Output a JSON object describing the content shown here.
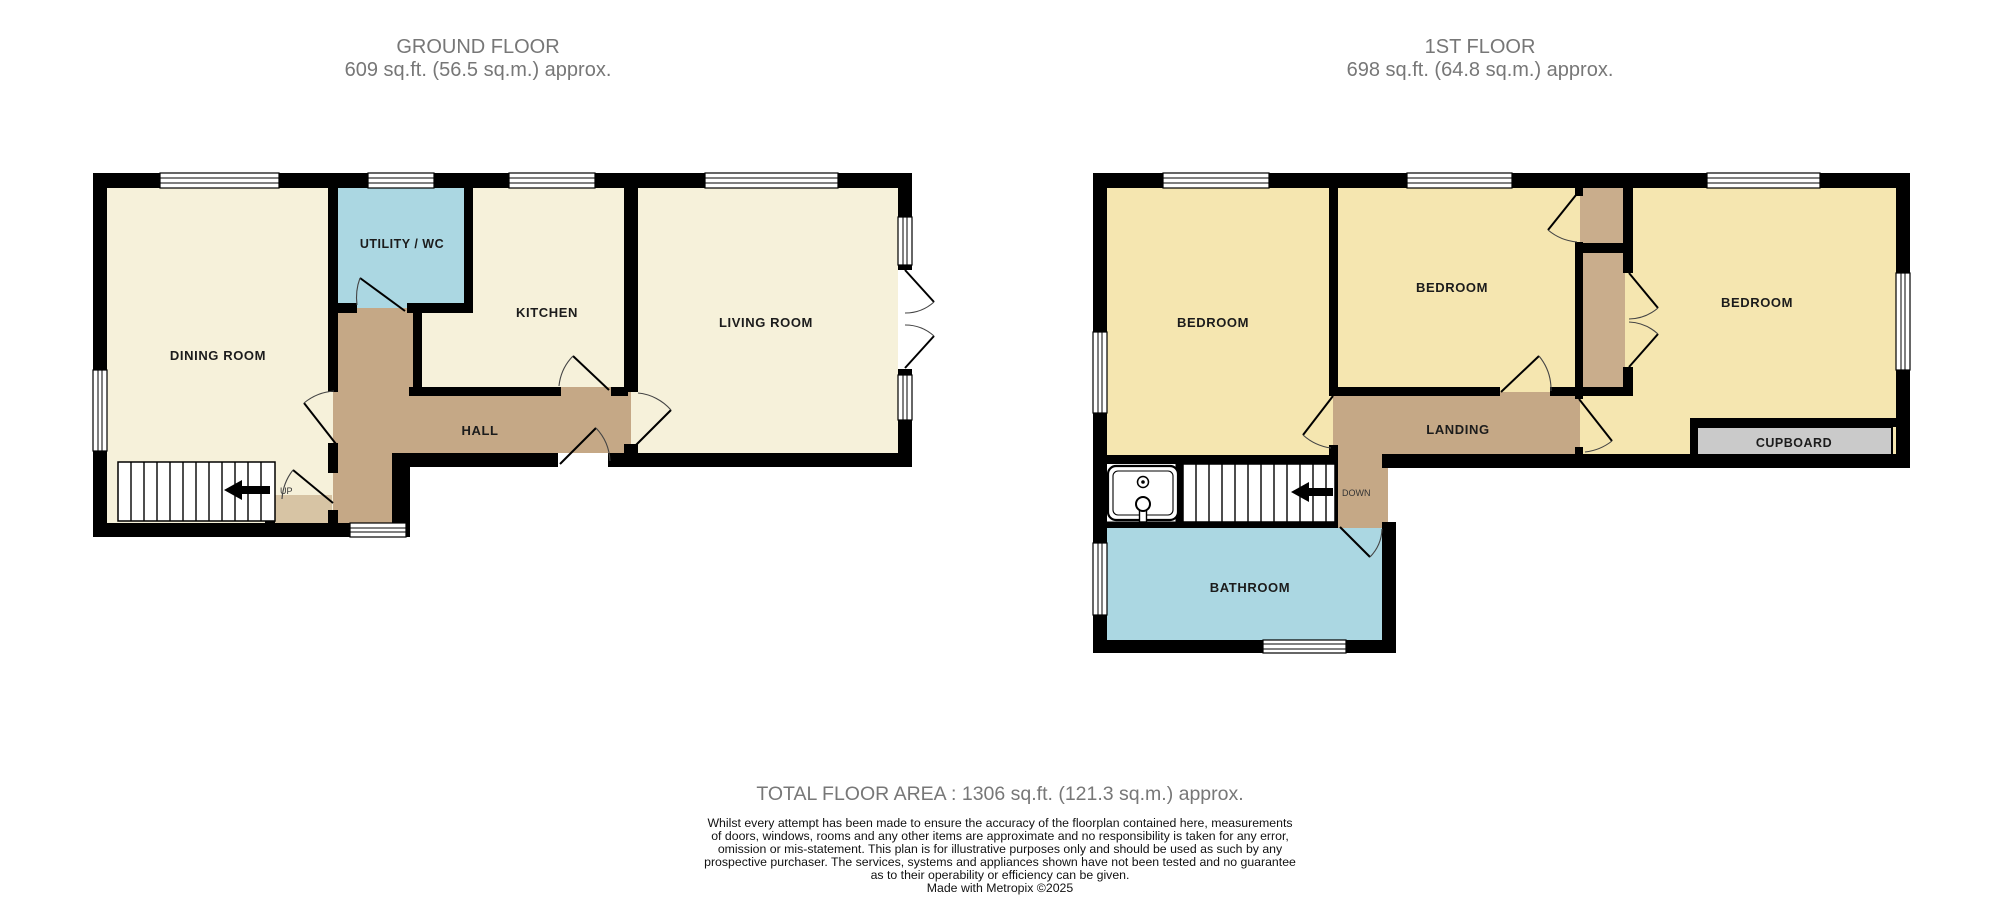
{
  "floors": [
    {
      "title": "GROUND FLOOR",
      "area": "609 sq.ft. (56.5 sq.m.) approx.",
      "rooms": {
        "dining": "DINING ROOM",
        "utility": "UTILITY / WC",
        "kitchen": "KITCHEN",
        "living": "LIVING ROOM",
        "hall": "HALL"
      },
      "stair_label": "UP"
    },
    {
      "title": "1ST FLOOR",
      "area": "698 sq.ft. (64.8 sq.m.) approx.",
      "rooms": {
        "bedroom_left": "BEDROOM",
        "bedroom_middle": "BEDROOM",
        "bedroom_right": "BEDROOM",
        "landing": "LANDING",
        "bathroom": "BATHROOM",
        "cupboard": "CUPBOARD"
      },
      "stair_label": "DOWN"
    }
  ],
  "footer": {
    "total": "TOTAL FLOOR AREA : 1306 sq.ft. (121.3 sq.m.) approx.",
    "disclaimer_lines": [
      "Whilst every attempt has been made to ensure the accuracy of the floorplan contained here, measurements",
      "of doors, windows, rooms and any other items are approximate and no responsibility is taken for any error,",
      "omission or mis-statement. This plan is for illustrative purposes only and should be used as such by any",
      "prospective purchaser. The services, systems and appliances shown have not been tested and no guarantee",
      "as to their operability or efficiency can be given."
    ],
    "credit": "Made with Metropix ©2025"
  },
  "colors": {
    "floor_cream": "#F6F1DA",
    "floor_yellow": "#F5E6B0",
    "floor_blue": "#ABD7E2",
    "hall_brown": "#C5A886",
    "alcove_tan": "#D7C4A4",
    "strip_brown": "#C9AD8C",
    "cupboard_gray": "#CACACA",
    "wall": "#000000",
    "title_gray": "#777777",
    "label": "#1C1C1C"
  }
}
